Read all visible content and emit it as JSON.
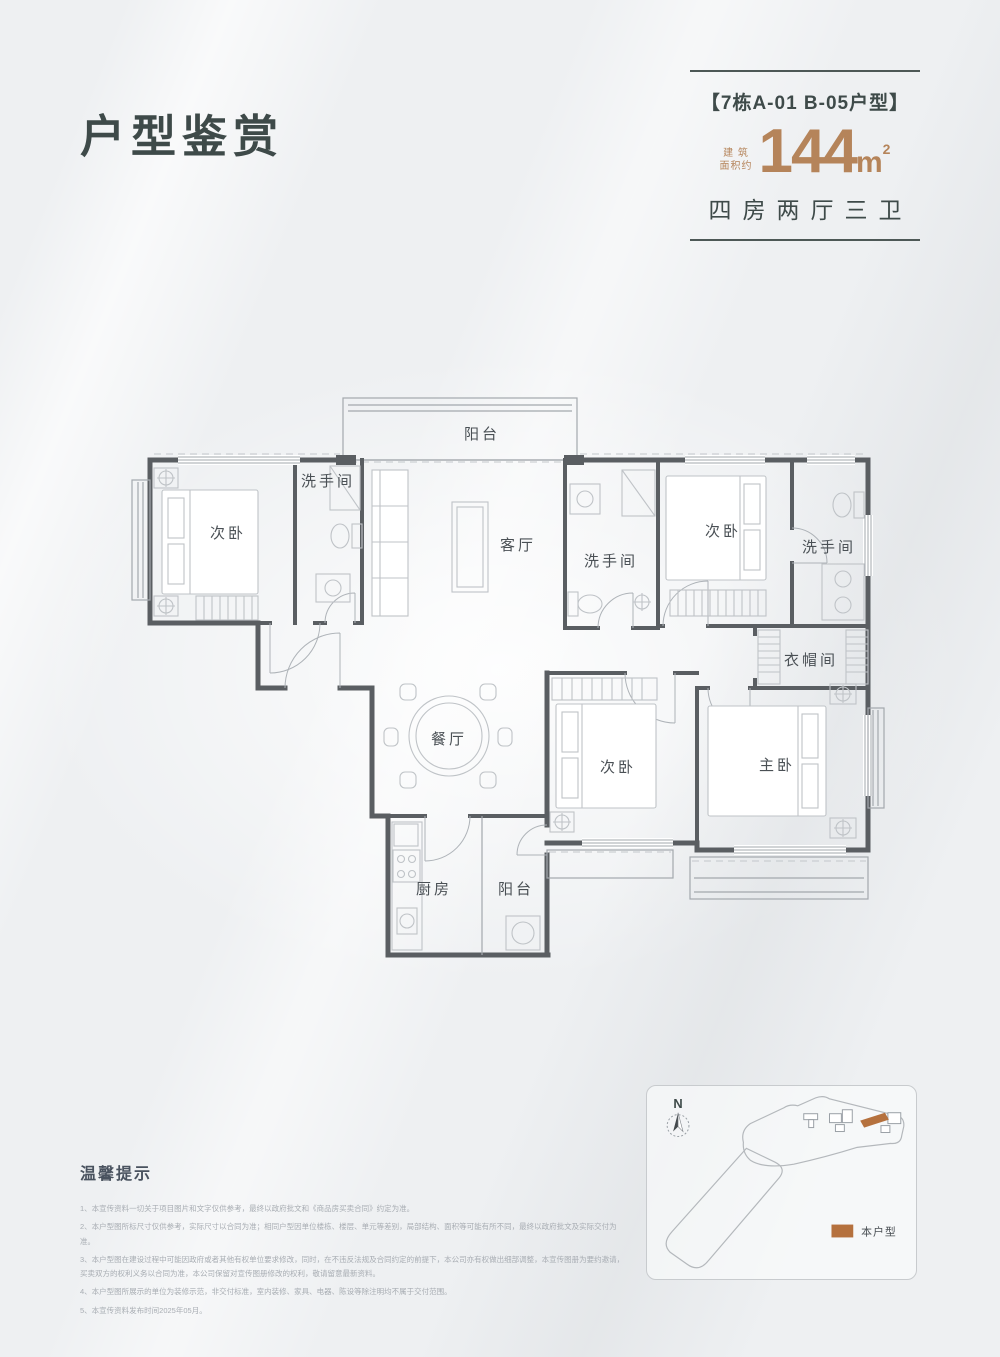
{
  "theme": {
    "ink": "#3e4a49",
    "accent": "#b5845a",
    "legend": "#b5713e",
    "wall": "#5a5e62",
    "line": "#a3a8ad",
    "furn": "#bfc3c7",
    "label": "#4a5055",
    "tip": "#a8adb3",
    "tiphead": "#49525f",
    "bg": "#eef0f2"
  },
  "title": "户型鉴赏",
  "header": {
    "unit_tag": "【7栋A-01 B-05户型】",
    "area_prefix_line1": "建 筑",
    "area_prefix_line2": "面积约",
    "area_value": "144",
    "area_unit": "m",
    "area_exponent": "2",
    "layout_summary": "四房两厅三卫"
  },
  "plan": {
    "rooms": [
      {
        "id": "balcony-top",
        "label": "阳台"
      },
      {
        "id": "bedroom-top-left",
        "label": "次卧"
      },
      {
        "id": "bath-top-left",
        "label": "洗手间"
      },
      {
        "id": "living-room",
        "label": "客厅"
      },
      {
        "id": "bath-middle",
        "label": "洗手间"
      },
      {
        "id": "bedroom-top-right",
        "label": "次卧"
      },
      {
        "id": "bath-right",
        "label": "洗手间"
      },
      {
        "id": "cloakroom",
        "label": "衣帽间"
      },
      {
        "id": "dining-room",
        "label": "餐厅"
      },
      {
        "id": "bedroom-bottom",
        "label": "次卧"
      },
      {
        "id": "master-bedroom",
        "label": "主卧"
      },
      {
        "id": "kitchen",
        "label": "厨房"
      },
      {
        "id": "balcony-bottom",
        "label": "阳台"
      }
    ]
  },
  "site_map": {
    "north_label": "N",
    "legend_label": "本户型"
  },
  "tips": {
    "heading": "温馨提示",
    "items": [
      "1、本宣传资料一切关于项目图片和文字仅供参考，最终以政府批文和《商品房买卖合同》约定为准。",
      "2、本户型图所标尺寸仅供参考，实际尺寸以合同为准；相同户型因单位楼栋、楼层、单元等差别，局部结构、面积等可能有所不同，最终以政府批文及实际交付为准。",
      "3、本户型图在建设过程中可能因政府或者其他有权单位要求修改，同时，在不违反法规及合同约定的前提下，本公司亦有权做出细部调整，本宣传图册为要约邀请，买卖双方的权利义务以合同为准，本公司保留对宣传图册修改的权利，敬请留意最新资料。",
      "4、本户型图所展示的单位为装修示范，非交付标准，室内装修、家具、电器、陈设等除注明均不属于交付范围。",
      "5、本宣传资料发布时间2025年05月。"
    ]
  }
}
